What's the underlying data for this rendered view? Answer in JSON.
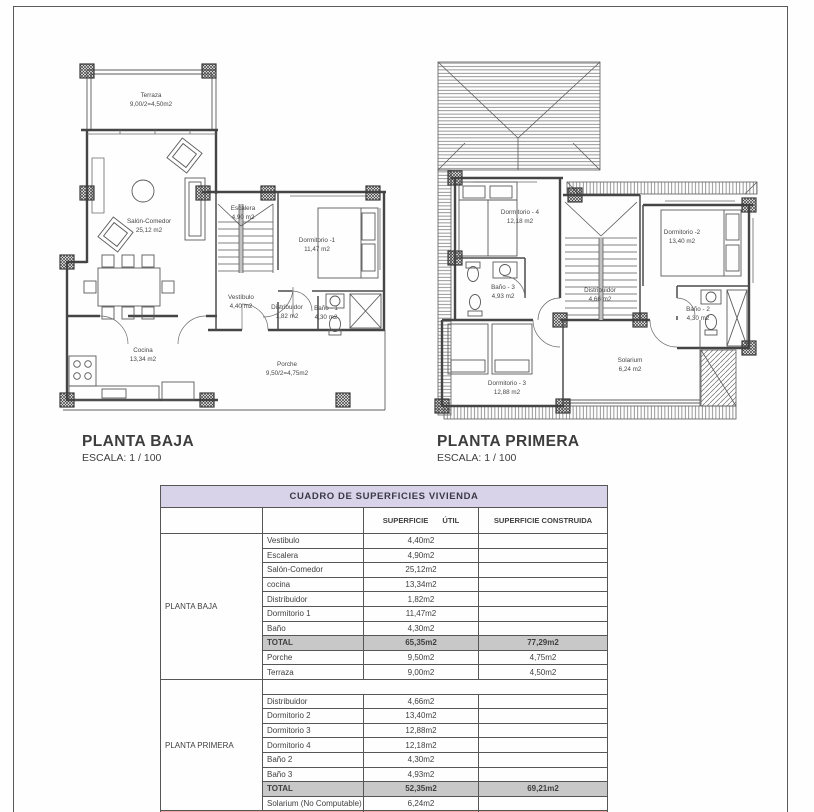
{
  "colors": {
    "table_header_bg": "#d8d3e8",
    "total_row_bg": "#c8c8c8",
    "grand_total_bg": "#f2a3a3",
    "line_color": "#4a4a4a"
  },
  "plans": {
    "planta_baja": {
      "title": "PLANTA BAJA",
      "scale": "ESCALA: 1 / 100",
      "rooms": {
        "terraza": {
          "name": "Terraza",
          "area": "9,00/2=4,50m2"
        },
        "salon": {
          "name": "Salón-Comedor",
          "area": "25,12 m2"
        },
        "escalera": {
          "name": "Escalera",
          "area": "4,90 m2"
        },
        "dormitorio1": {
          "name": "Dormitorio -1",
          "area": "11,47 m2"
        },
        "vestibulo": {
          "name": "Vestíbulo",
          "area": "4,40 m2"
        },
        "distribuidor": {
          "name": "Distribuidor",
          "area": "1,82 m2"
        },
        "bano1": {
          "name": "Baño - 1",
          "area": "4,30 m2"
        },
        "cocina": {
          "name": "Cocina",
          "area": "13,34 m2"
        },
        "porche": {
          "name": "Porche",
          "area": "9,50/2=4,75m2"
        }
      }
    },
    "planta_primera": {
      "title": "PLANTA PRIMERA",
      "scale": "ESCALA: 1 / 100",
      "rooms": {
        "dormitorio4": {
          "name": "Dormitorio - 4",
          "area": "12,18 m2"
        },
        "dormitorio2": {
          "name": "Dormitorio -2",
          "area": "13,40 m2"
        },
        "bano3": {
          "name": "Baño - 3",
          "area": "4,93 m2"
        },
        "distribuidor": {
          "name": "Distribuidor",
          "area": "4,66 m2"
        },
        "bano2": {
          "name": "Baño - 2",
          "area": "4,30 m2"
        },
        "dormitorio3": {
          "name": "Dormitorio - 3",
          "area": "12,88 m2"
        },
        "solarium": {
          "name": "Solarium",
          "area": "6,24 m2"
        }
      }
    }
  },
  "table": {
    "title": "CUADRO DE SUPERFICIES VIVIENDA",
    "col_util": "SUPERFICIE ÚTIL",
    "col_construida": "SUPERFICIE CONSTRUIDA",
    "sections": [
      {
        "label": "PLANTA BAJA",
        "rows": [
          {
            "name": "Vestibulo",
            "util": "4,40m2",
            "construida": ""
          },
          {
            "name": "Escalera",
            "util": "4,90m2",
            "construida": ""
          },
          {
            "name": "Salón-Comedor",
            "util": "25,12m2",
            "construida": ""
          },
          {
            "name": "cocina",
            "util": "13,34m2",
            "construida": ""
          },
          {
            "name": "Distribuidor",
            "util": "1,82m2",
            "construida": ""
          },
          {
            "name": "Dormitorio 1",
            "util": "11,47m2",
            "construida": ""
          },
          {
            "name": "Baño",
            "util": "4,30m2",
            "construida": ""
          },
          {
            "name": "TOTAL",
            "util": "65,35m2",
            "construida": "77,29m2",
            "type": "total"
          },
          {
            "name": "Porche",
            "util": "9,50m2",
            "construida": "4,75m2"
          },
          {
            "name": "Terraza",
            "util": "9,00m2",
            "construida": "4,50m2"
          }
        ]
      },
      {
        "label": "PLANTA PRIMERA",
        "rows": [
          {
            "name": "",
            "util": "",
            "construida": "",
            "type": "spacer"
          },
          {
            "name": "Distribuidor",
            "util": "4,66m2",
            "construida": ""
          },
          {
            "name": "Dormitorio 2",
            "util": "13,40m2",
            "construida": ""
          },
          {
            "name": "Dormitorio 3",
            "util": "12,88m2",
            "construida": ""
          },
          {
            "name": "Dormitorio 4",
            "util": "12,18m2",
            "construida": ""
          },
          {
            "name": "Baño 2",
            "util": "4,30m2",
            "construida": ""
          },
          {
            "name": "Baño 3",
            "util": "4,93m2",
            "construida": ""
          },
          {
            "name": "TOTAL",
            "util": "52,35m2",
            "construida": "69,21m2",
            "type": "total"
          },
          {
            "name": "Solarium (No Computable)",
            "util": "6,24m2",
            "construida": ""
          }
        ]
      }
    ],
    "grand_total": {
      "label": "TOTAL SUPERFICIES",
      "util": "136,20m2",
      "construida": "155,75m2"
    }
  }
}
